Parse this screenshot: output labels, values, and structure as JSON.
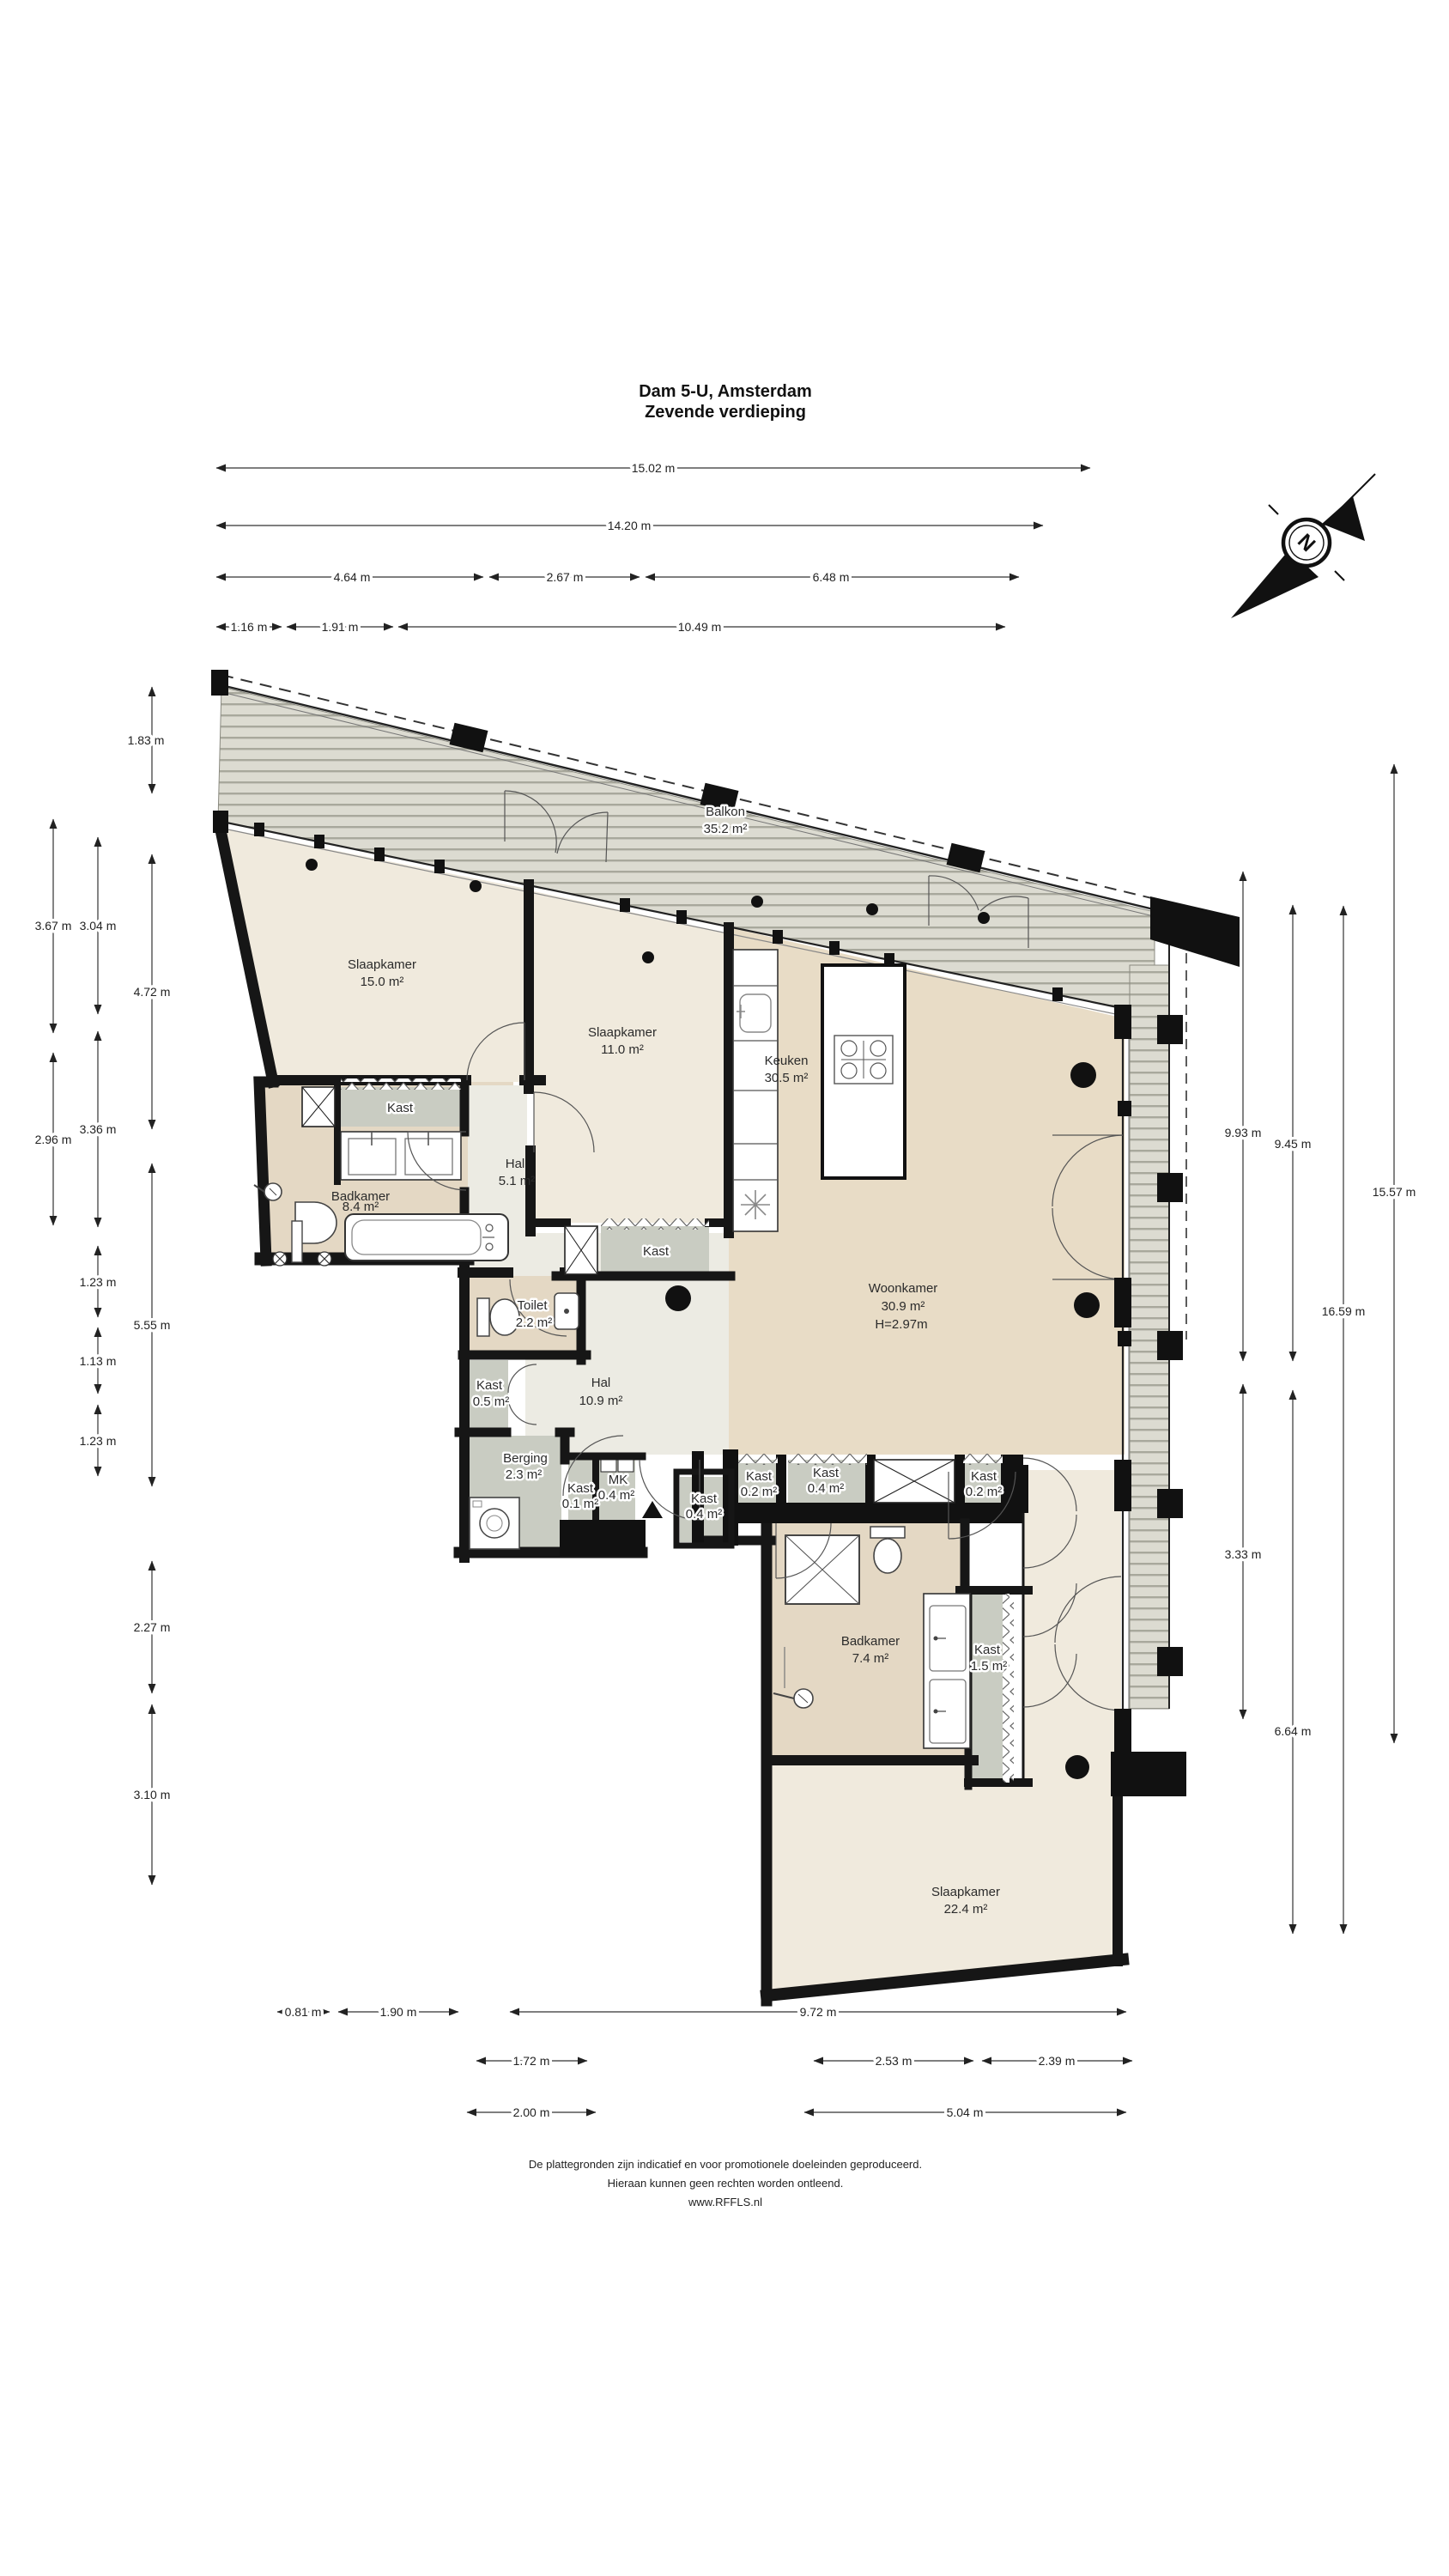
{
  "title": {
    "line1": "Dam 5-U, Amsterdam",
    "line2": "Zevende verdieping"
  },
  "compass": {
    "letter": "N"
  },
  "rooms": {
    "balkon": {
      "name": "Balkon",
      "area": "35.2 m²"
    },
    "slaapkamer1": {
      "name": "Slaapkamer",
      "area": "15.0 m²"
    },
    "slaapkamer2": {
      "name": "Slaapkamer",
      "area": "11.0 m²"
    },
    "keuken": {
      "name": "Keuken",
      "area": "30.5 m²"
    },
    "kast_top": {
      "name": "Kast"
    },
    "badkamer1": {
      "name": "Badkamer",
      "area": "8.4 m²"
    },
    "hal1": {
      "name": "Hal",
      "area": "5.1 m²"
    },
    "kast_s2": {
      "name": "Kast"
    },
    "toilet": {
      "name": "Toilet",
      "area": "2.2 m²"
    },
    "kast05": {
      "name": "Kast",
      "area": "0.5 m²"
    },
    "hal2": {
      "name": "Hal",
      "area": "10.9 m²"
    },
    "woonkamer": {
      "name": "Woonkamer",
      "area": "30.9 m²",
      "height": "H=2.97m"
    },
    "berging": {
      "name": "Berging",
      "area": "2.3 m²"
    },
    "kast01": {
      "name": "Kast",
      "area": "0.1 m²"
    },
    "mk": {
      "name": "MK",
      "area": "0.4 m²"
    },
    "kast04a": {
      "name": "Kast",
      "area": "0.4 m²"
    },
    "kast02a": {
      "name": "Kast",
      "area": "0.2 m²"
    },
    "kast04b": {
      "name": "Kast",
      "area": "0.4 m²"
    },
    "kast02b": {
      "name": "Kast",
      "area": "0.2 m²"
    },
    "badkamer2": {
      "name": "Badkamer",
      "area": "7.4 m²"
    },
    "kast15": {
      "name": "Kast",
      "area": "1.5 m²"
    },
    "slaapkamer3": {
      "name": "Slaapkamer",
      "area": "22.4 m²"
    }
  },
  "dims": {
    "t1": "15.02 m",
    "t2": "14.20 m",
    "t3a": "4.64 m",
    "t3b": "2.67 m",
    "t3c": "6.48 m",
    "t4a": "1.16 m",
    "t4b": "1.91 m",
    "t4c": "10.49 m",
    "l1": "1.83 m",
    "l2": "3.67 m",
    "l3": "3.04 m",
    "l4": "4.72 m",
    "l5": "2.96 m",
    "l6": "3.36 m",
    "l7": "1.23 m",
    "l8": "5.55 m",
    "l9": "1.13 m",
    "l10": "1.23 m",
    "l11": "2.27 m",
    "l12": "3.10 m",
    "r1": "9.93 m",
    "r2": "9.45 m",
    "r3": "16.59 m",
    "r4": "15.57 m",
    "r5": "3.33 m",
    "r6": "6.64 m",
    "b1a": "0.81 m",
    "b1b": "1.90 m",
    "b1c": "9.72 m",
    "b2a": "1.72 m",
    "b2b": "2.53 m",
    "b2c": "2.39 m",
    "b3a": "2.00 m",
    "b3b": "5.04 m"
  },
  "footer": {
    "line1": "De plattegronden zijn indicatief en voor promotionele doeleinden geproduceerd.",
    "line2": "Hieraan kunnen geen rechten worden ontleend.",
    "line3": "www.RFFLS.nl"
  },
  "colors": {
    "wall": "#161616",
    "cream": "#F0EADD",
    "tan": "#E8DCC6",
    "gray_closet": "#C9CCC2",
    "hall": "#ECEBE3",
    "deck": "#DCDBD1",
    "deck_stripe": "#A8A89C"
  }
}
